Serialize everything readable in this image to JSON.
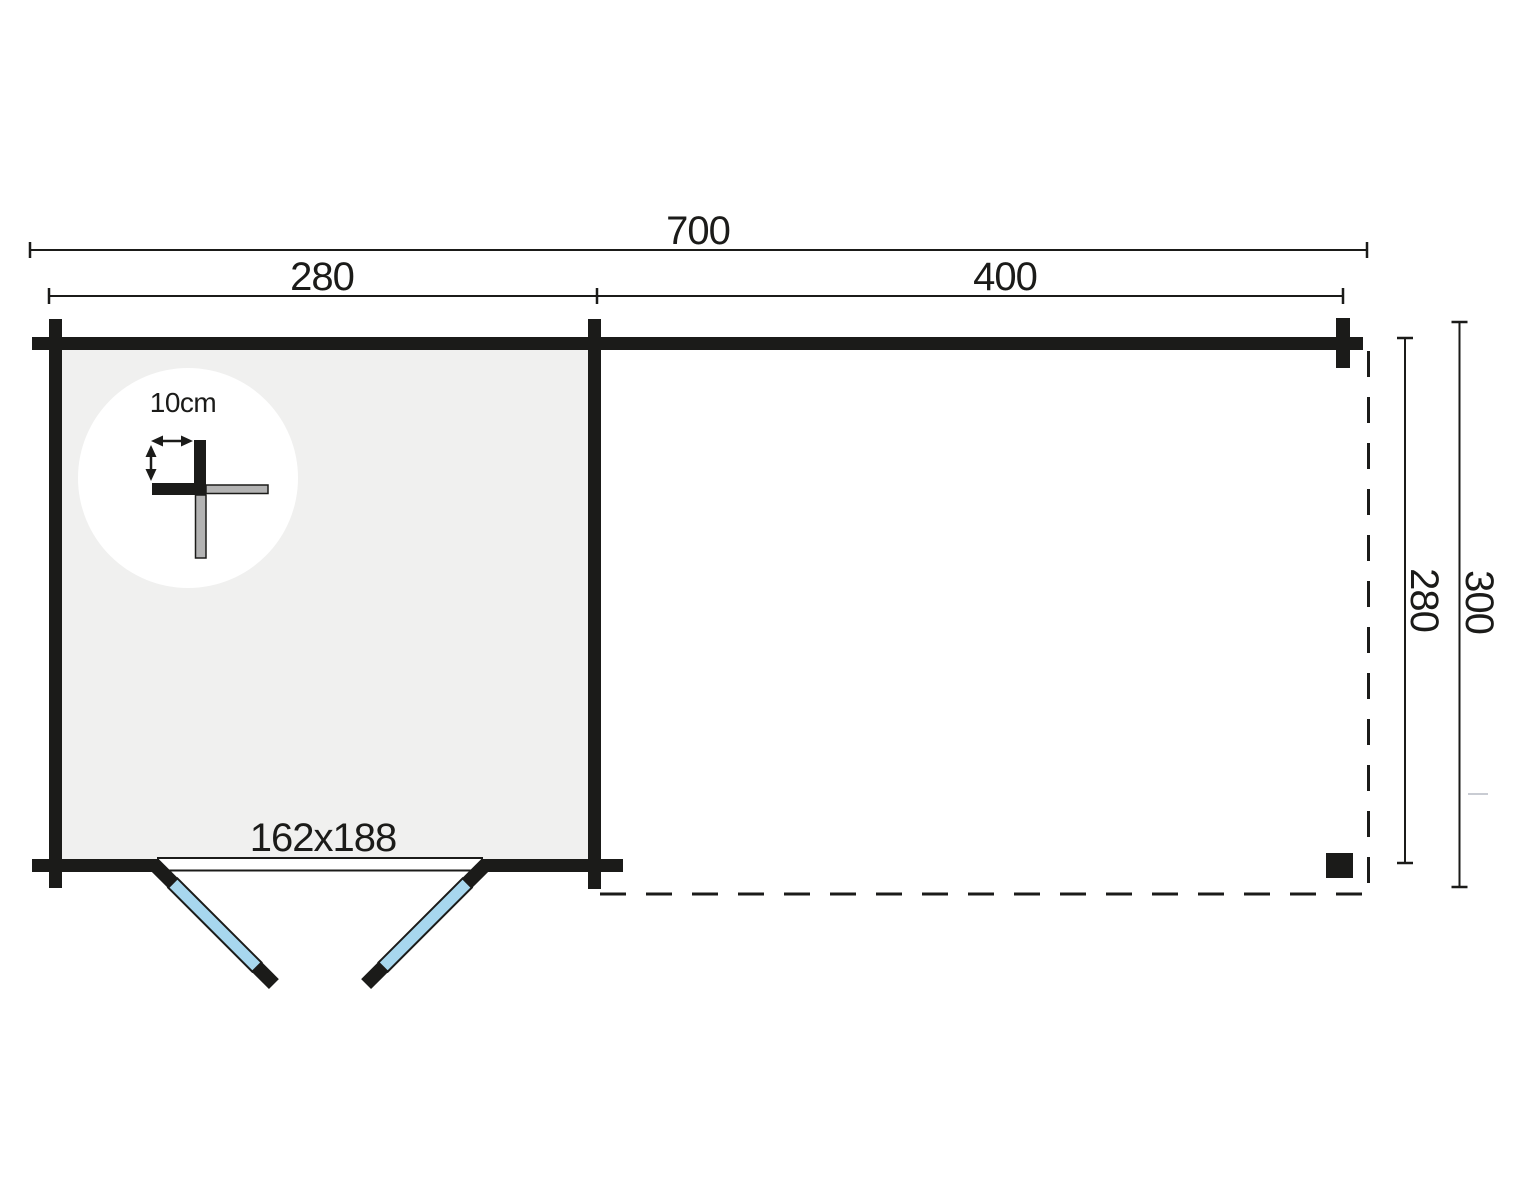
{
  "plan": {
    "type": "floor-plan",
    "dimensions_top": {
      "total_width": "700",
      "cabin_width": "280",
      "annex_width": "400"
    },
    "dimensions_right": {
      "inner_depth": "280",
      "outer_depth": "300"
    },
    "door": {
      "size": "162x188"
    },
    "wall_detail": {
      "thickness": "10cm"
    },
    "colors": {
      "line": "#1b1b19",
      "cabin_fill": "#f0f0ef",
      "door_leaf": "#a7d7ee",
      "log_end": "#b3b3b3",
      "detail_background": "#ffffff",
      "faint_mark": "#c9ccd3"
    }
  }
}
